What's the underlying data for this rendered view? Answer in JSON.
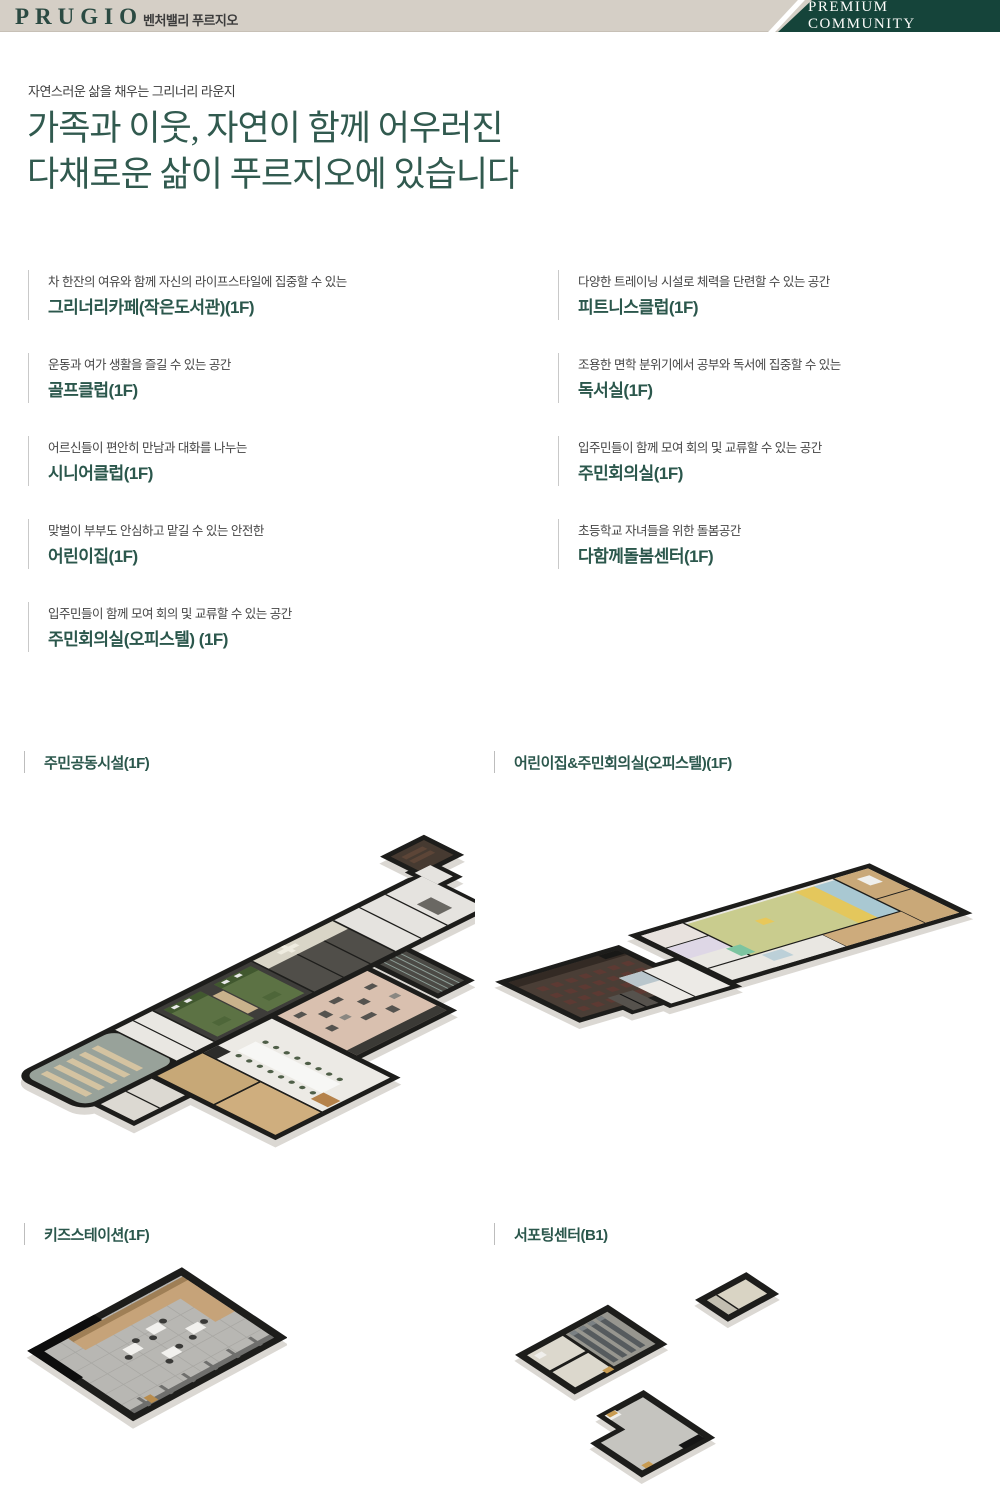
{
  "header": {
    "logo": "PRUGIO",
    "brand_subtitle": "벤처밸리 푸르지오",
    "badge": "PREMIUM COMMUNITY"
  },
  "intro": {
    "eyebrow": "자연스러운 삶을 채우는 그리너리 라운지",
    "title_line1": "가족과 이웃, 자연이 함께 어우러진",
    "title_line2": "다채로운 삶이 푸르지오에 있습니다"
  },
  "facilities": [
    {
      "desc": "차 한잔의 여유와 함께 자신의 라이프스타일에 집중할 수 있는",
      "name": "그리너리카페(작은도서관)(1F)"
    },
    {
      "desc": "다양한 트레이닝 시설로 체력을 단련할 수 있는 공간",
      "name": "피트니스클럽(1F)"
    },
    {
      "desc": "운동과 여가 생활을 즐길 수 있는 공간",
      "name": "골프클럽(1F)"
    },
    {
      "desc": "조용한 면학 분위기에서 공부와 독서에 집중할 수 있는",
      "name": "독서실(1F)"
    },
    {
      "desc": "어르신들이 편안히 만남과 대화를 나누는",
      "name": "시니어클럽(1F)"
    },
    {
      "desc": "입주민들이 함께 모여 회의 및 교류할 수 있는 공간",
      "name": "주민회의실(1F)"
    },
    {
      "desc": "맞벌이 부부도 안심하고 맡길 수 있는 안전한",
      "name": "어린이집(1F)"
    },
    {
      "desc": "초등학교 자녀들을 위한 돌봄공간",
      "name": "다함께돌봄센터(1F)"
    },
    {
      "desc": "입주민들이 함께 모여 회의 및 교류할 수 있는 공간",
      "name": "주민회의실(오피스텔) (1F)"
    }
  ],
  "floor_plans": [
    {
      "label": "주민공동시설(1F)"
    },
    {
      "label": "어린이집&주민회의실(오피스텔)(1F)"
    },
    {
      "label": "키즈스테이션(1F)"
    },
    {
      "label": "서포팅센터(B1)"
    }
  ],
  "colors": {
    "header_beige": "#d5cfc6",
    "badge_green": "#15443a",
    "logo_green": "#2b4a42",
    "title_green": "#315a4f",
    "name_green": "#2b574c",
    "desc_gray": "#454545",
    "bar_gray": "#c9c9c9"
  }
}
